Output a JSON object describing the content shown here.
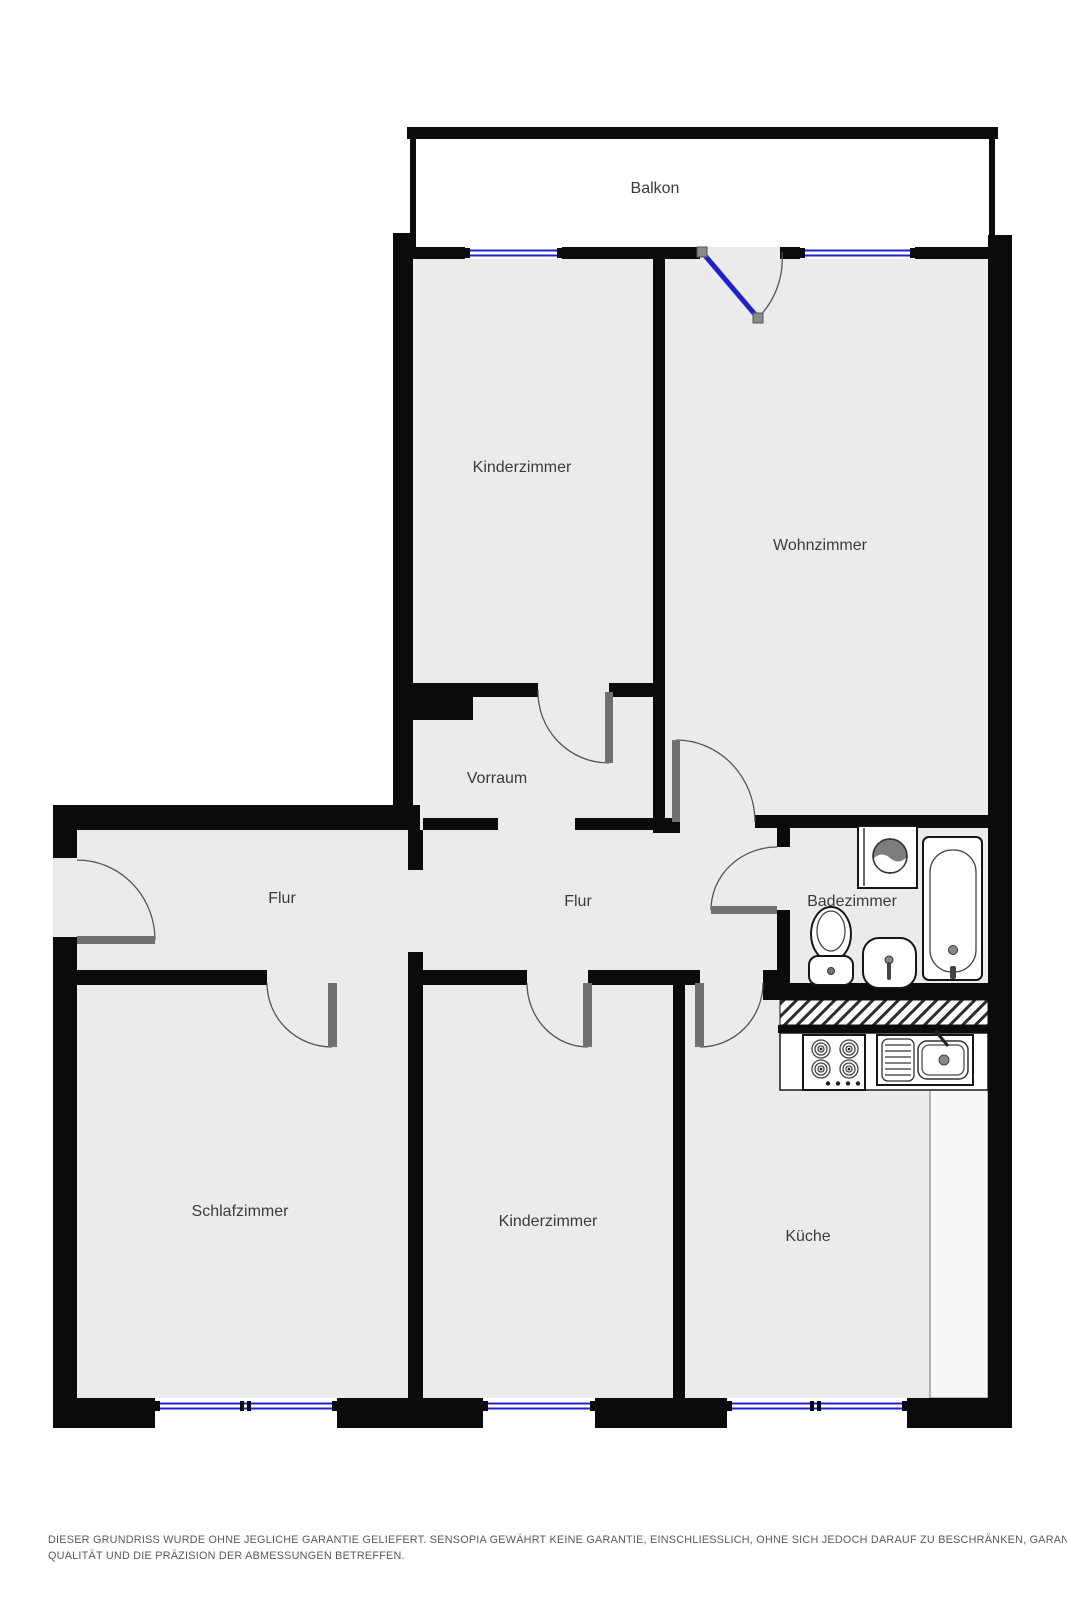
{
  "rooms": {
    "balkon": "Balkon",
    "kinderzimmer_top": "Kinderzimmer",
    "wohnzimmer": "Wohnzimmer",
    "vorraum": "Vorraum",
    "flur_left": "Flur",
    "flur_center": "Flur",
    "badezimmer": "Badezimmer",
    "schlafzimmer": "Schlafzimmer",
    "kinderzimmer_bottom": "Kinderzimmer",
    "kueche": "Küche"
  },
  "disclaimer": {
    "line1": "DIESER GRUNDRISS WURDE OHNE JEGLICHE GARANTIE GELIEFERT. SENSOPIA GEWÄHRT KEINE GARANTIE, EINSCHLIESSLICH, OHNE SICH JEDOCH DARAUF ZU BESCHRÄNKEN, GARANTIEN, DIE DIE",
    "line2": "QUALITÄT UND DIE PRÄZISION DER ABMESSUNGEN BETREFFEN."
  },
  "colors": {
    "wall": "#0b0b0b",
    "floor": "#ebebeb",
    "window_blue": "#2121cc",
    "door_gray": "#707070",
    "arc_gray": "#555555",
    "label_text": "#3b3b3b",
    "disclaimer_text": "#5a5a5a",
    "counter_white": "#f8f8f8"
  }
}
